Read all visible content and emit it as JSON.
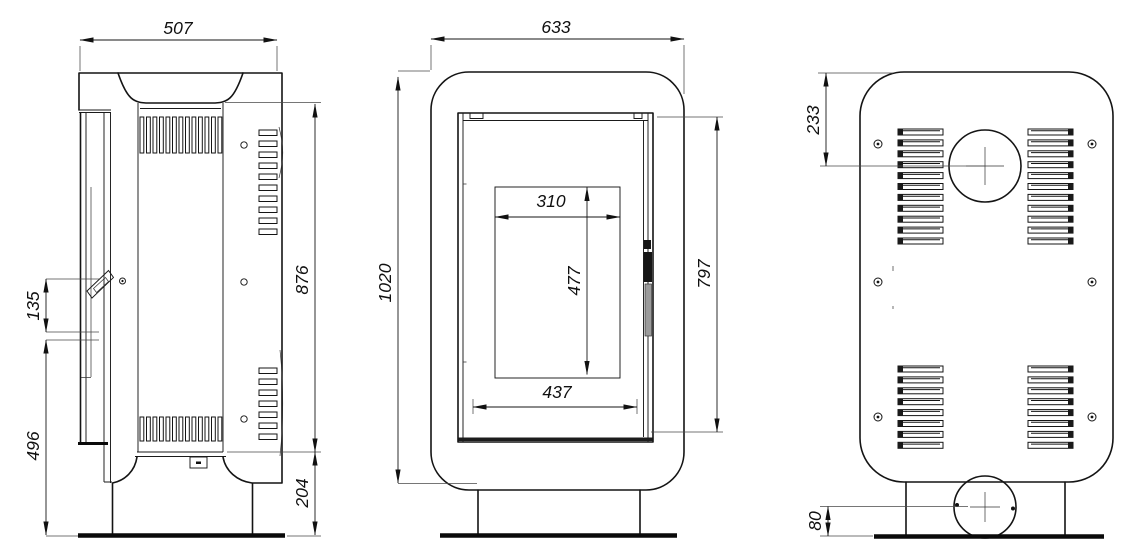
{
  "drawing": {
    "kind": "three-view stove dimensional drawing",
    "colors": {
      "line": "#141414",
      "background": "#ffffff"
    }
  },
  "dims": {
    "side_width": "507",
    "side_body_height": "876",
    "side_base_height": "204",
    "side_handle_span": "135",
    "side_handle_floor_height": "496",
    "front_width": "633",
    "front_total_height": "1020",
    "front_glass_width": "310",
    "front_glass_height": "477",
    "front_firebox_width": "437",
    "front_door_height": "797",
    "back_flue_offset": "233",
    "back_inlet_height": "80"
  }
}
